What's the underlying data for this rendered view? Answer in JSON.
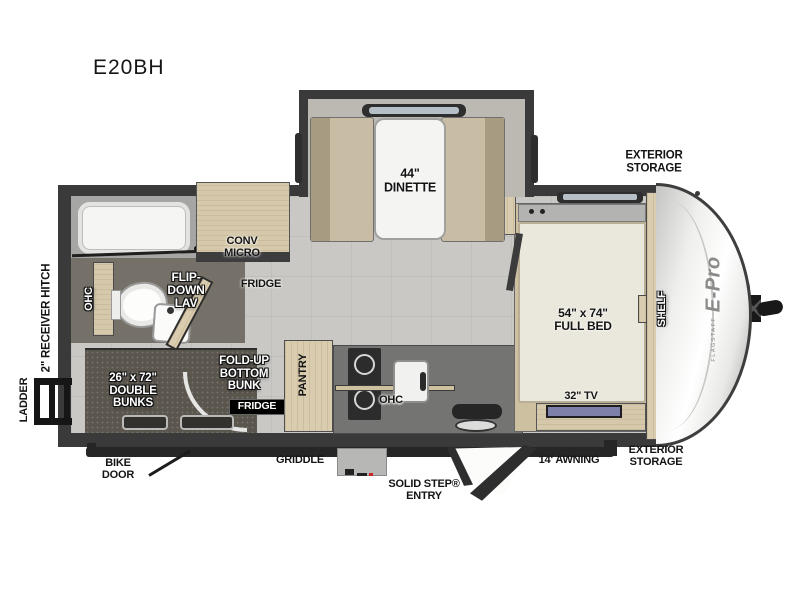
{
  "title": "E20BH",
  "colors": {
    "wall": "#3a3a3a",
    "floor": "#c9c8c4",
    "wood": "#dacdaf",
    "bunk_dark": "#5a554d",
    "tv_screen": "#7d80a9",
    "logo_gray": "#8a8a88",
    "accent_red": "#cc2222"
  },
  "plan": {
    "slide": {
      "dinette": "44\"\nDINETTE"
    },
    "interior": {
      "conv_micro": "CONV\nMICRO",
      "fridge": "FRIDGE",
      "flip_down_lav": "FLIP-\nDOWN\nLAV",
      "ohc_bath": "OHC",
      "double_bunks": "26\" x 72\"\nDOUBLE\nBUNKS",
      "fold_up_bunk": "FOLD-UP\nBOTTOM\nBUNK",
      "fridge_badge": "FRIDGE",
      "pantry": "PANTRY",
      "ohc_kitchen": "OHC",
      "full_bed": "54\" x 74\"\nFULL BED",
      "shelf": "SHELF",
      "tv": "32\" TV"
    },
    "exterior": {
      "storage_top": "EXTERIOR\nSTORAGE",
      "storage_bottom": "EXTERIOR\nSTORAGE",
      "awning": "14' AWNING",
      "solid_step": "SOLID STEP®\nENTRY",
      "griddle": "GRIDDLE",
      "bike_door": "BIKE\nDOOR",
      "ladder": "LADDER",
      "receiver_hitch": "2\" RECEIVER HITCH"
    },
    "logo": {
      "brand_small": "FLAGSTAFF",
      "brand": "E-Pro"
    }
  }
}
